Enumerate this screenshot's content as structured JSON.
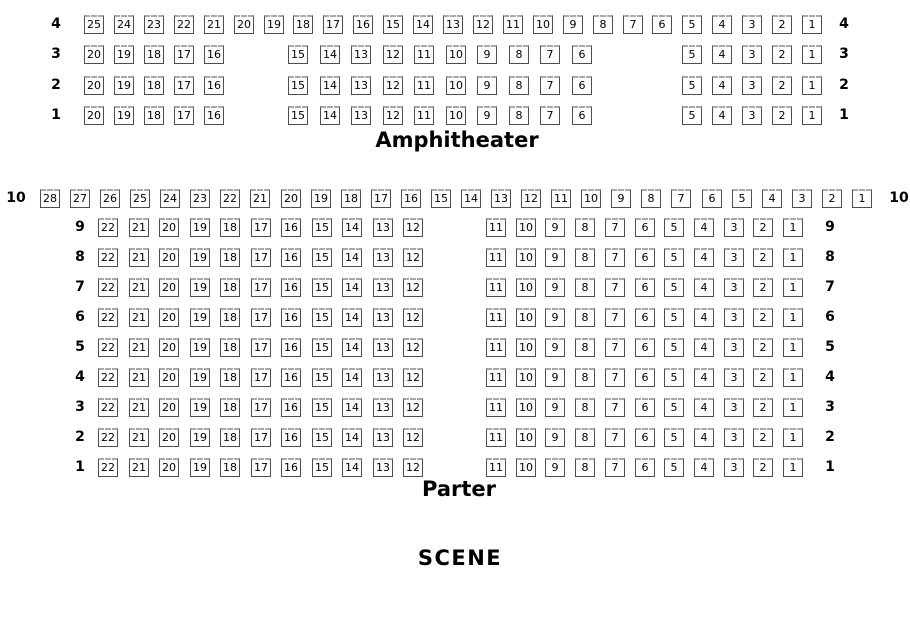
{
  "stage_label": "SCENE",
  "colors": {
    "seat_border": "#4d4d4d",
    "seat_back": "#a9a9a9",
    "seat_text": "#000000",
    "background": "#ffffff"
  },
  "sections": [
    {
      "id": "amphitheater",
      "title": "Amphitheater",
      "rows": [
        {
          "label": "4",
          "groups": [
            [
              25,
              24,
              23,
              22,
              21,
              20,
              19,
              18,
              17,
              16,
              15,
              14,
              13,
              12,
              11,
              10,
              9,
              8,
              7,
              6,
              5,
              4,
              3,
              2,
              1
            ]
          ]
        },
        {
          "label": "3",
          "groups": [
            [
              20,
              19,
              18,
              17,
              16
            ],
            [
              15,
              14,
              13,
              12,
              11,
              10,
              9,
              8,
              7,
              6
            ],
            [
              5,
              4,
              3,
              2,
              1
            ]
          ]
        },
        {
          "label": "2",
          "groups": [
            [
              20,
              19,
              18,
              17,
              16
            ],
            [
              15,
              14,
              13,
              12,
              11,
              10,
              9,
              8,
              7,
              6
            ],
            [
              5,
              4,
              3,
              2,
              1
            ]
          ]
        },
        {
          "label": "1",
          "groups": [
            [
              20,
              19,
              18,
              17,
              16
            ],
            [
              15,
              14,
              13,
              12,
              11,
              10,
              9,
              8,
              7,
              6
            ],
            [
              5,
              4,
              3,
              2,
              1
            ]
          ]
        }
      ]
    },
    {
      "id": "parter",
      "title": "Parter",
      "rows": [
        {
          "label": "10",
          "groups": [
            [
              28,
              27,
              26,
              25,
              24,
              23,
              22,
              21,
              20,
              19,
              18,
              17,
              16,
              15,
              14,
              13,
              12,
              11,
              10,
              9,
              8,
              7,
              6,
              5,
              4,
              3,
              2,
              1
            ]
          ]
        },
        {
          "label": "9",
          "groups": [
            [
              22,
              21,
              20,
              19,
              18,
              17,
              16,
              15,
              14,
              13,
              12
            ],
            [
              11,
              10,
              9,
              8,
              7,
              6,
              5,
              4,
              3,
              2,
              1
            ]
          ]
        },
        {
          "label": "8",
          "groups": [
            [
              22,
              21,
              20,
              19,
              18,
              17,
              16,
              15,
              14,
              13,
              12
            ],
            [
              11,
              10,
              9,
              8,
              7,
              6,
              5,
              4,
              3,
              2,
              1
            ]
          ]
        },
        {
          "label": "7",
          "groups": [
            [
              22,
              21,
              20,
              19,
              18,
              17,
              16,
              15,
              14,
              13,
              12
            ],
            [
              11,
              10,
              9,
              8,
              7,
              6,
              5,
              4,
              3,
              2,
              1
            ]
          ]
        },
        {
          "label": "6",
          "groups": [
            [
              22,
              21,
              20,
              19,
              18,
              17,
              16,
              15,
              14,
              13,
              12
            ],
            [
              11,
              10,
              9,
              8,
              7,
              6,
              5,
              4,
              3,
              2,
              1
            ]
          ]
        },
        {
          "label": "5",
          "groups": [
            [
              22,
              21,
              20,
              19,
              18,
              17,
              16,
              15,
              14,
              13,
              12
            ],
            [
              11,
              10,
              9,
              8,
              7,
              6,
              5,
              4,
              3,
              2,
              1
            ]
          ]
        },
        {
          "label": "4",
          "groups": [
            [
              22,
              21,
              20,
              19,
              18,
              17,
              16,
              15,
              14,
              13,
              12
            ],
            [
              11,
              10,
              9,
              8,
              7,
              6,
              5,
              4,
              3,
              2,
              1
            ]
          ]
        },
        {
          "label": "3",
          "groups": [
            [
              22,
              21,
              20,
              19,
              18,
              17,
              16,
              15,
              14,
              13,
              12
            ],
            [
              11,
              10,
              9,
              8,
              7,
              6,
              5,
              4,
              3,
              2,
              1
            ]
          ]
        },
        {
          "label": "2",
          "groups": [
            [
              22,
              21,
              20,
              19,
              18,
              17,
              16,
              15,
              14,
              13,
              12
            ],
            [
              11,
              10,
              9,
              8,
              7,
              6,
              5,
              4,
              3,
              2,
              1
            ]
          ]
        },
        {
          "label": "1",
          "groups": [
            [
              22,
              21,
              20,
              19,
              18,
              17,
              16,
              15,
              14,
              13,
              12
            ],
            [
              11,
              10,
              9,
              8,
              7,
              6,
              5,
              4,
              3,
              2,
              1
            ]
          ]
        }
      ]
    }
  ]
}
